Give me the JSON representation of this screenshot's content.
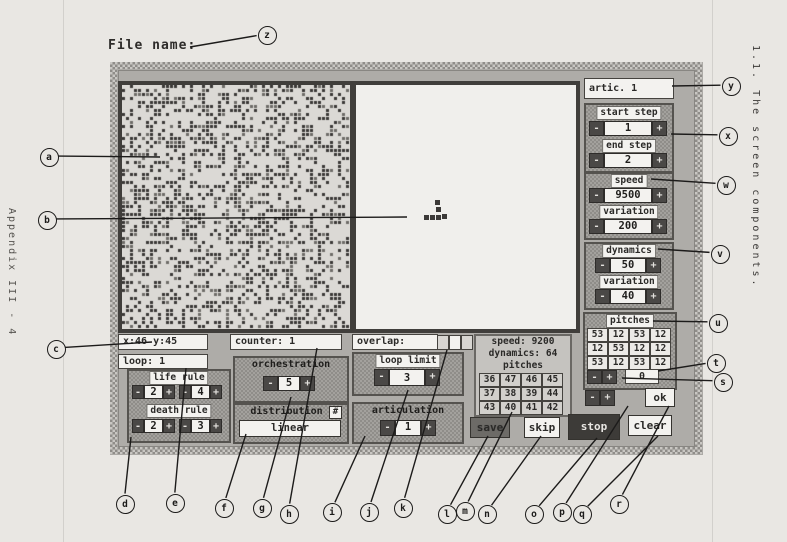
{
  "page": {
    "file_name_label": "File name:",
    "appendix_label": "Appendix III - 4",
    "section_label": "1.1. The screen components."
  },
  "ui": {
    "minus": "-",
    "plus": "+",
    "hash": "#"
  },
  "right_panel": {
    "artic": "artic. 1",
    "start_step": {
      "label": "start step",
      "value": "1"
    },
    "end_step": {
      "label": "end step",
      "value": "2"
    },
    "speed": {
      "label": "speed",
      "value": "9500"
    },
    "speed_variation": {
      "label": "variation",
      "value": "200"
    },
    "dynamics": {
      "label": "dynamics",
      "value": "50"
    },
    "dynamics_variation": {
      "label": "variation",
      "value": "40"
    },
    "pitches": {
      "label": "pitches",
      "grid": [
        [
          "53",
          "12",
          "53",
          "12"
        ],
        [
          "12",
          "53",
          "12",
          "12"
        ],
        [
          "53",
          "12",
          "53",
          "12"
        ]
      ],
      "transpose": "0"
    },
    "ok": "ok"
  },
  "bottom_panel": {
    "coords": "x:46 y:45",
    "counter": "counter: 1",
    "loop": "loop:  1",
    "life_rule": {
      "label": "life rule",
      "v1": "2",
      "v2": "4"
    },
    "death_rule": {
      "label": "death rule",
      "v1": "2",
      "v2": "3"
    },
    "orchestration": {
      "label": "orchestration",
      "value": "5"
    },
    "distribution": {
      "label": "distribution",
      "value": "linear"
    },
    "overlap_label": "overlap:",
    "loop_limit": {
      "label": "loop limit",
      "value": "3"
    },
    "articulation": {
      "label": "articulation",
      "value": "1"
    },
    "status": {
      "speed": "speed: 9200",
      "dynamics": "dynamics: 64",
      "pitches_label": "pitches",
      "grid": [
        [
          "36",
          "47",
          "46",
          "45"
        ],
        [
          "37",
          "38",
          "39",
          "44"
        ],
        [
          "43",
          "40",
          "41",
          "42"
        ]
      ]
    },
    "buttons": {
      "save": "save",
      "skip": "skip",
      "stop": "stop",
      "clear": "clear"
    }
  },
  "callouts": [
    "a",
    "b",
    "c",
    "d",
    "e",
    "f",
    "g",
    "h",
    "i",
    "j",
    "k",
    "l",
    "m",
    "n",
    "o",
    "p",
    "q",
    "r",
    "s",
    "t",
    "u",
    "v",
    "w",
    "x",
    "y",
    "z"
  ]
}
